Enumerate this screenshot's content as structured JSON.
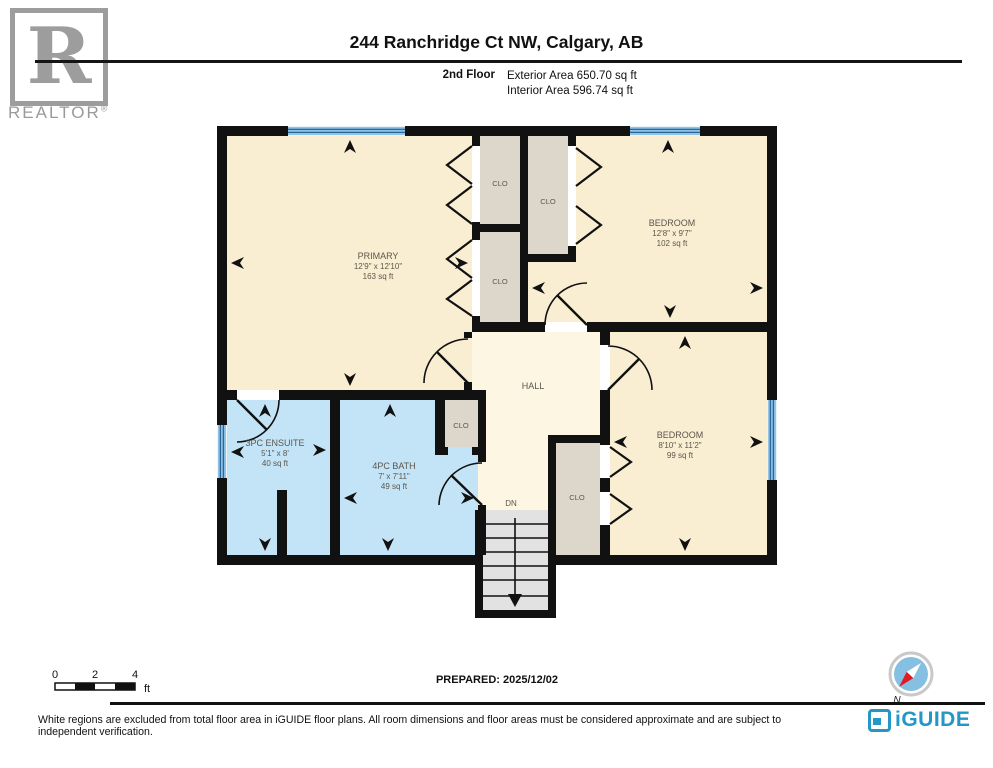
{
  "header": {
    "realtor_logo_letter": "R",
    "realtor_logo_text": "REALTOR",
    "realtor_reg": "®",
    "title": "244 Ranchridge Ct NW, Calgary, AB",
    "floor_label": "2nd Floor",
    "exterior_area": "Exterior Area 650.70 sq ft",
    "interior_area": "Interior Area 596.74 sq ft"
  },
  "rooms": {
    "primary": {
      "name": "PRIMARY",
      "dims": "12'9\" x 12'10\"",
      "area": "163 sq ft"
    },
    "bedroom_top": {
      "name": "BEDROOM",
      "dims": "12'8\" x 9'7\"",
      "area": "102 sq ft"
    },
    "bedroom_bottom": {
      "name": "BEDROOM",
      "dims": "8'10\" x 11'2\"",
      "area": "99 sq ft"
    },
    "ensuite": {
      "name": "3PC ENSUITE",
      "dims": "5'1\" x 8'",
      "area": "40 sq ft"
    },
    "bath": {
      "name": "4PC BATH",
      "dims": "7' x 7'11\"",
      "area": "49 sq ft"
    },
    "hall": {
      "name": "HALL"
    },
    "closet_label": "CLO",
    "stairs_label": "DN"
  },
  "footer": {
    "scale": {
      "tick0": "0",
      "tick2": "2",
      "tick4": "4",
      "unit": "ft"
    },
    "prepared": "PREPARED: 2025/12/02",
    "compass_north": "N",
    "disclaimer": "White regions are excluded from total floor area in iGUIDE floor plans. All room dimensions and floor areas must be considered approximate and are subject to independent verification.",
    "brand": "iGUIDE"
  },
  "colors": {
    "wall": "#111111",
    "room_cream": "#F9EDD2",
    "hall_cream": "#FCF6E2",
    "bath_blue": "#C3E3F6",
    "closet_grey": "#DCD6CB",
    "window_blue": "#8FC3E8",
    "brand_blue": "#2497C7",
    "logo_grey": "#9D9D9D"
  }
}
